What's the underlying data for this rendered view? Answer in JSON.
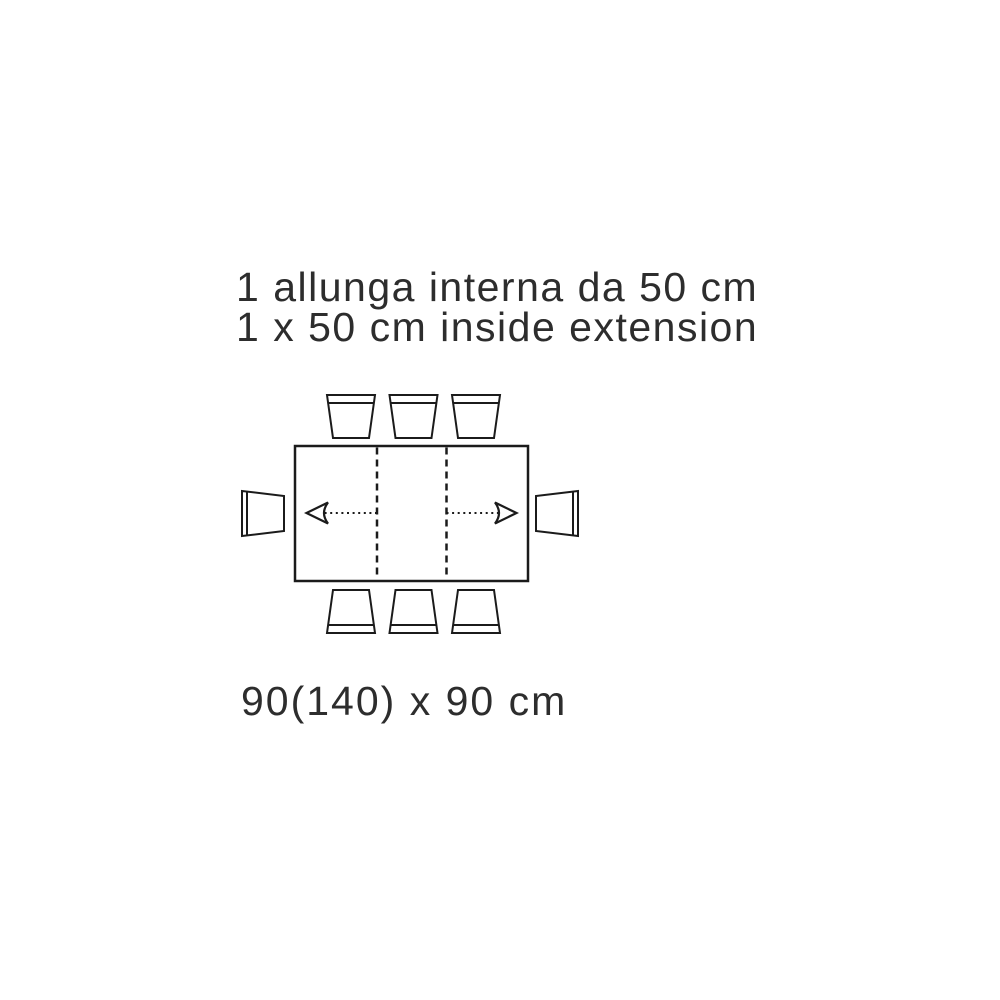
{
  "page": {
    "background": "#ffffff"
  },
  "colors": {
    "line": "#1b1b1b",
    "text": "#2d2d2d"
  },
  "caption": {
    "line1_it": "1 allunga interna da 50 cm",
    "line2_en": "1 x 50 cm inside extension"
  },
  "dimension_label": "90(140) x 90 cm",
  "diagram": {
    "type": "table-extension-plan",
    "table_shape": "rectangle",
    "extension": {
      "count": 1,
      "size_cm": 50,
      "type": "inside"
    },
    "closed_size_cm": "90 x 90",
    "extended_length_cm": 140,
    "leaf_divider_lines": 2,
    "arrows": [
      "left",
      "right"
    ],
    "chairs": {
      "top": 3,
      "bottom": 3,
      "left": 1,
      "right": 1,
      "total": 8
    }
  }
}
